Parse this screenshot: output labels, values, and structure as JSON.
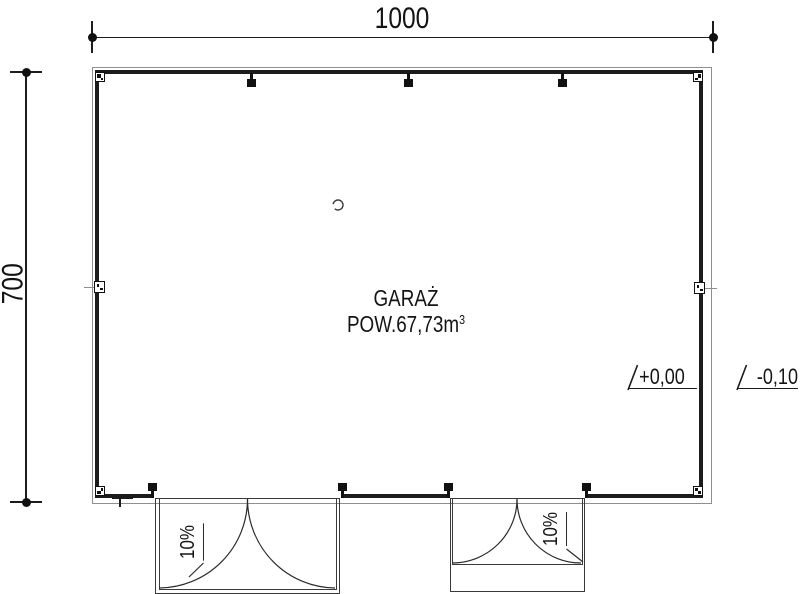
{
  "labels": {
    "width_dim": "1000",
    "height_dim": "700",
    "room_name": "GARAŻ",
    "volume_prefix": "POW.67,73m",
    "volume_sup": "3",
    "level_inside": "+0,00",
    "level_outside": "-0,10",
    "slope_left": "10%",
    "slope_right": "10%"
  },
  "colors": {
    "line": "#1c1c1c",
    "thin_line": "#8f8f8f",
    "background": "#ffffff"
  }
}
